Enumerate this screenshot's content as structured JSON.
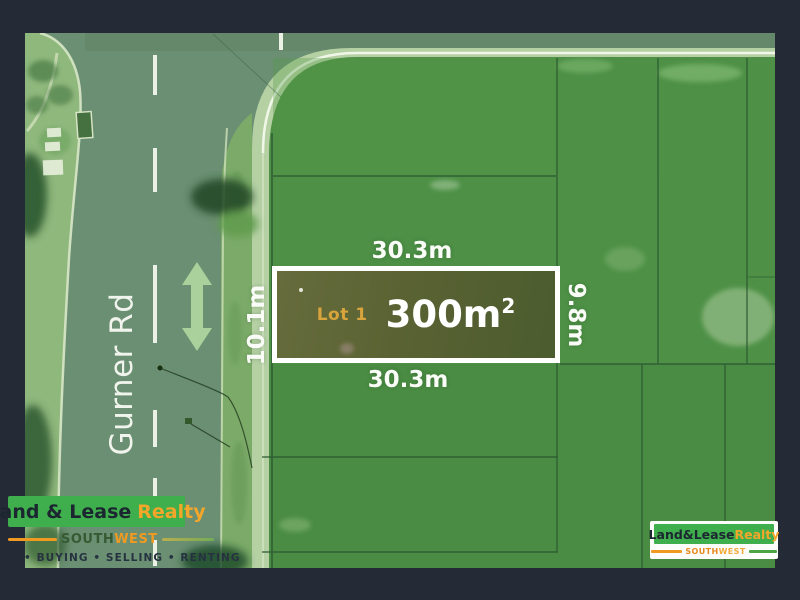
{
  "frame": {
    "background": "#252b36"
  },
  "map": {
    "road_name": "Gurner Rd",
    "lot": {
      "label": "Lot 1",
      "area_value": "300m",
      "area_sup": "2"
    },
    "dimensions": {
      "top": "30.3m",
      "bottom": "30.3m",
      "left": "10.1m",
      "right": "9.8m"
    },
    "colors": {
      "field_green": "#4d9046",
      "road_green": "#6a8f72",
      "lot_fill": "#5a6233",
      "lot_border": "#ffffff",
      "lot_label_orange": "#d8a43c",
      "arrow_green": "#aed49d"
    }
  },
  "branding_left": {
    "name_dark": "Land & Lease",
    "name_accent": "Realty",
    "region_prefix": "SOUTH",
    "region_suffix": "WEST",
    "tagline": "• BUYING  • SELLING  • RENTING",
    "banner_green": "#3fae4c",
    "accent_orange": "#f09a22"
  },
  "branding_right": {
    "name_dark": "Land&Lease",
    "name_accent": "Realty",
    "region_prefix": "SOUTH",
    "region_suffix": "WEST"
  }
}
